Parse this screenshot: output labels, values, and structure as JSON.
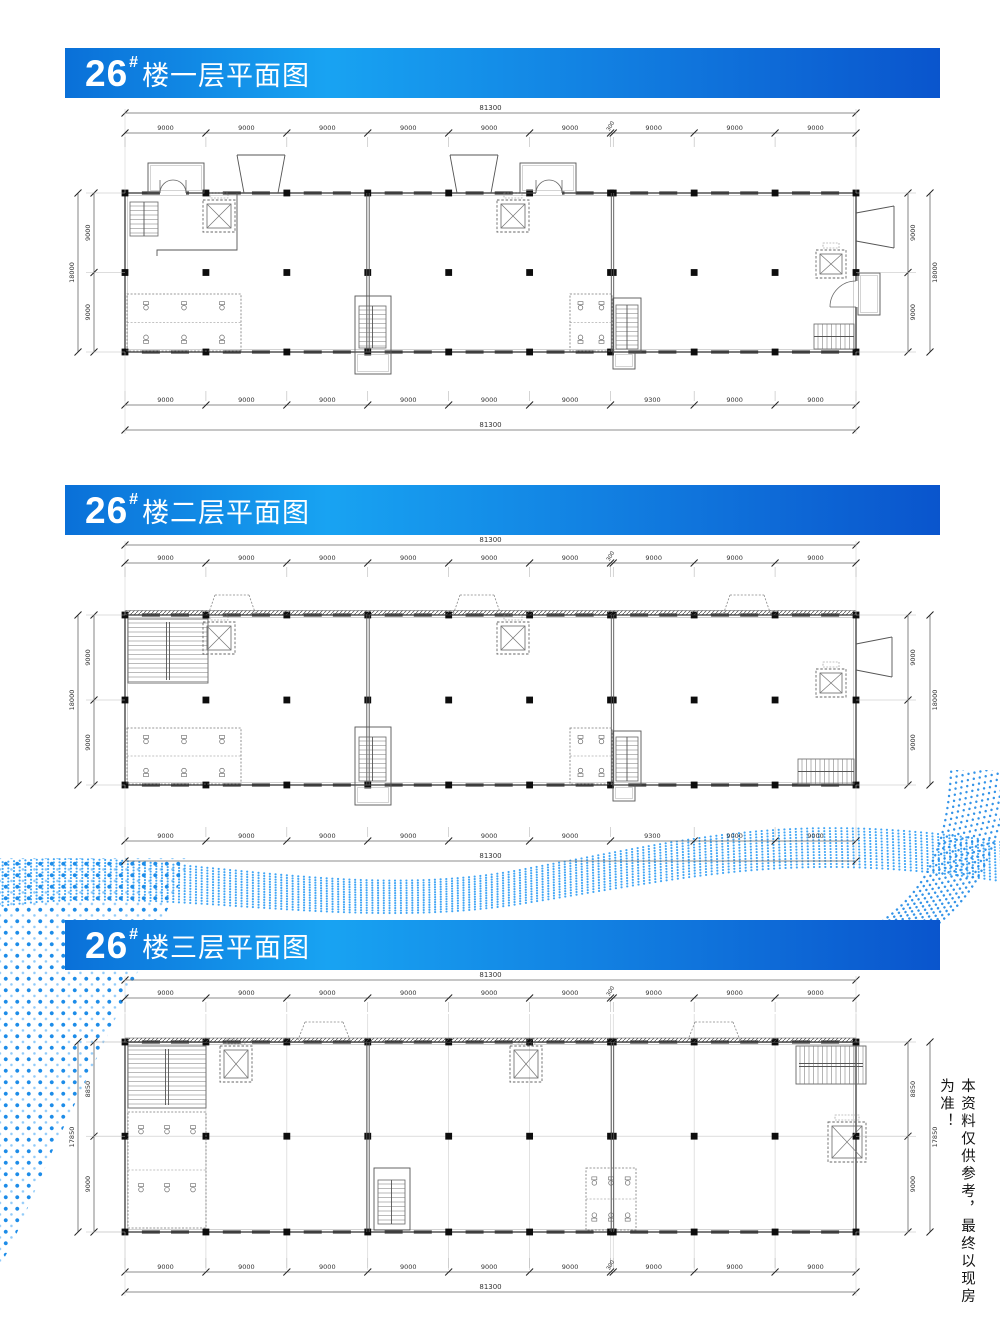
{
  "page": {
    "background": "#ffffff",
    "accent": "#1e88e5",
    "header_gradient": [
      "#0a70d8",
      "#18a3f2",
      "#0a55cd"
    ],
    "disclaimer": "本资料仅供参考，最终以现房为准！"
  },
  "sections": [
    {
      "id": "floor1",
      "building_no": "26",
      "superscript": "#",
      "title_suffix": "楼一层平面图",
      "dims": {
        "overall_width": "81300",
        "overall_height": "18000",
        "top": [
          "9000",
          "9000",
          "9000",
          "9000",
          "9000",
          "9000",
          "300",
          "9000",
          "9000",
          "9000"
        ],
        "bottom": [
          "9000",
          "9000",
          "9000",
          "9000",
          "9000",
          "9000",
          "9300",
          "9000",
          "9000"
        ],
        "left": [
          "9000",
          "9000"
        ],
        "right": [
          "9000",
          "9000"
        ]
      }
    },
    {
      "id": "floor2",
      "building_no": "26",
      "superscript": "#",
      "title_suffix": "楼二层平面图",
      "dims": {
        "overall_width": "81300",
        "overall_height": "18000",
        "top": [
          "9000",
          "9000",
          "9000",
          "9000",
          "9000",
          "9000",
          "300",
          "9000",
          "9000",
          "9000"
        ],
        "bottom": [
          "9000",
          "9000",
          "9000",
          "9000",
          "9000",
          "9000",
          "9300",
          "9000",
          "9000"
        ],
        "left": [
          "9000",
          "9000"
        ],
        "right": [
          "9000",
          "9000"
        ]
      }
    },
    {
      "id": "floor3",
      "building_no": "26",
      "superscript": "#",
      "title_suffix": "楼三层平面图",
      "dims": {
        "overall_width": "81300",
        "overall_height": "17850",
        "top": [
          "9000",
          "9000",
          "9000",
          "9000",
          "9000",
          "9000",
          "300",
          "9000",
          "9000",
          "9000"
        ],
        "bottom": [
          "9000",
          "9000",
          "9000",
          "9000",
          "9000",
          "9000",
          "300",
          "9000",
          "9000",
          "9000"
        ],
        "left": [
          "8850",
          "9000"
        ],
        "right": [
          "8850",
          "9000"
        ]
      }
    }
  ]
}
